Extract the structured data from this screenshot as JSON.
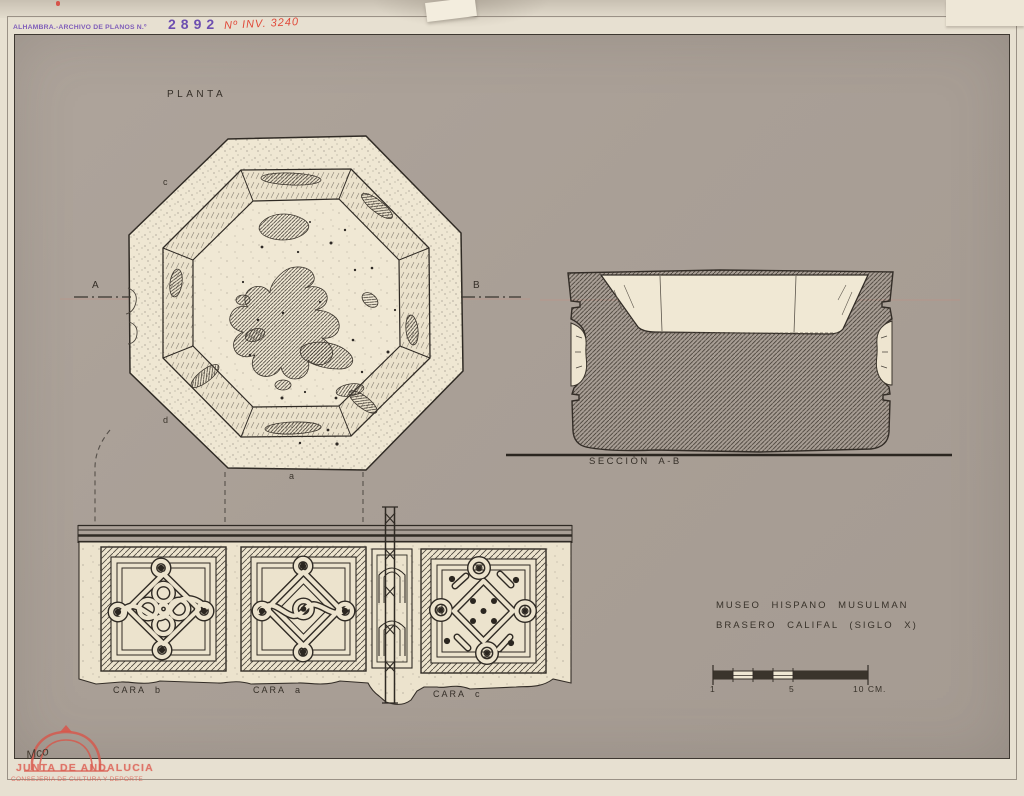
{
  "stamp": {
    "archive_label": "ALHAMBRA.-ARCHIVO DE PLANOS N.º",
    "archive_number": "2892",
    "inventory_number": "Nº INV. 3240"
  },
  "plan": {
    "title": "PLANTA",
    "marker_a": "A",
    "marker_b": "B",
    "face_letters": {
      "top_left": "c",
      "bottom_left": "d",
      "bottom": "a"
    }
  },
  "section": {
    "label": "SECCIÓN A-B"
  },
  "elevation": {
    "labels": [
      "CARA b",
      "CARA a",
      "CARA c"
    ]
  },
  "caption": {
    "line1": "MUSEO HISPANO MUSULMAN",
    "line2": "BRASERO CALIFAL (SIGLO X)"
  },
  "scale_bar": {
    "labels": [
      "1",
      "5",
      "10 CM."
    ]
  },
  "footer_stamp": {
    "handwritten": "Mco",
    "org": "JUNTA DE ANDALUCIA",
    "dept": "CONSEJERIA DE CULTURA Y DEPORTE"
  },
  "colors": {
    "sheet_gray": "#a9a097",
    "paper_cream": "#ece3cd",
    "ink": "#2f2a24",
    "stamp_purple": "#7a57b8",
    "stamp_red": "#e04a3a",
    "logo_red": "#dd5a4e"
  }
}
